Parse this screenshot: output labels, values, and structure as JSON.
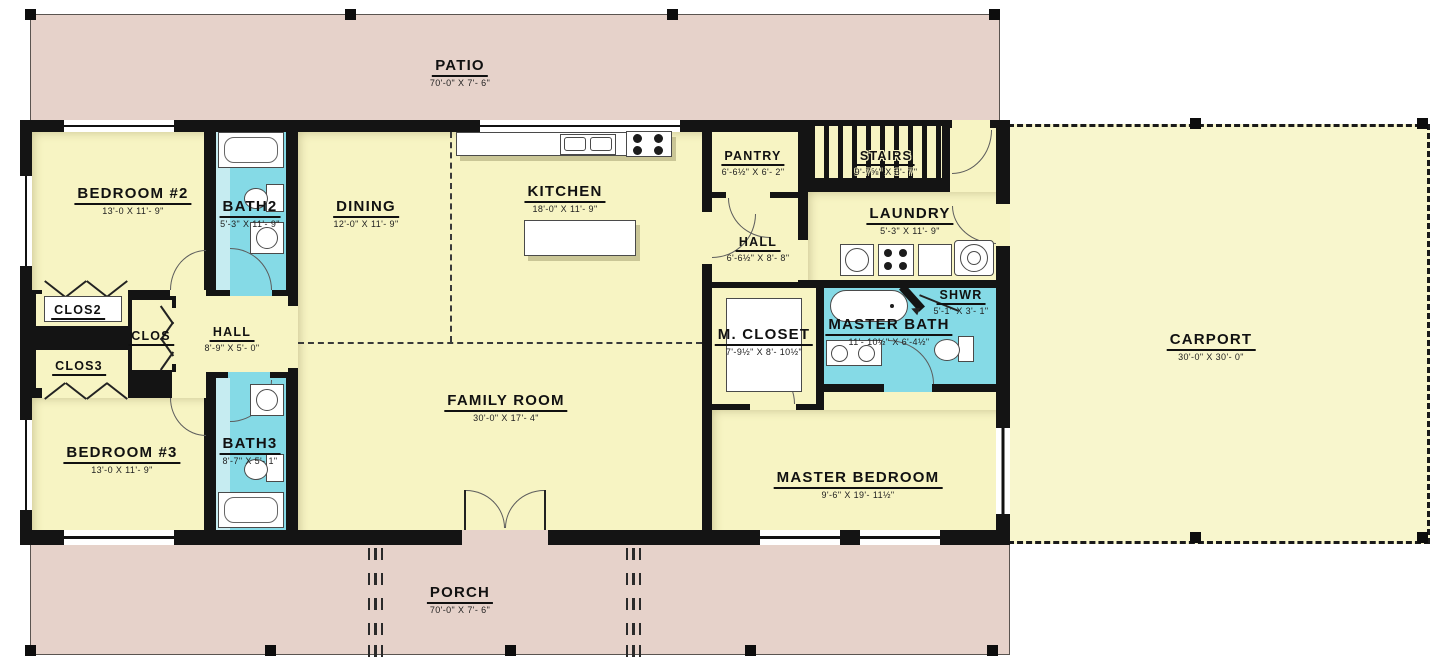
{
  "plan_type": "residential-floor-plan",
  "colors": {
    "deck_pink": "#e6d2ca",
    "room_yellow": "#f7f4c3",
    "carport_yellow": "#f8f6cd",
    "bath_cyan": "#85dae6",
    "bath_cyan_light": "#c6ecf1",
    "wall_black": "#141414"
  },
  "rooms": {
    "patio": {
      "label": "PATIO",
      "dims": "70'-0\" X 7'- 6\""
    },
    "bedroom2": {
      "label": "BEDROOM #2",
      "dims": "13'-0 X 11'- 9\""
    },
    "bath2": {
      "label": "BATH2",
      "dims": "5'-3\" X 11'- 9\""
    },
    "dining": {
      "label": "DINING",
      "dims": "12'-0\" X 11'- 9\""
    },
    "kitchen": {
      "label": "KITCHEN",
      "dims": "18'-0\" X 11'- 9\""
    },
    "pantry": {
      "label": "PANTRY",
      "dims": "6'-6½\" X 6'- 2\""
    },
    "stairs": {
      "label": "STAIRS",
      "dims": "9'-7⅝\" X 3'- 7\""
    },
    "hall_upper": {
      "label": "HALL",
      "dims": "6'-6½\" X 8'- 8\""
    },
    "laundry": {
      "label": "LAUNDRY",
      "dims": "5'-3\" X 11'- 9\""
    },
    "carport": {
      "label": "CARPORT",
      "dims": "30'-0\" X 30'- 0\""
    },
    "clos2": {
      "label": "CLOS2"
    },
    "clos": {
      "label": "CLOS"
    },
    "clos3": {
      "label": "CLOS3"
    },
    "hall_lower": {
      "label": "HALL",
      "dims": "8'-9\" X 5'- 0\""
    },
    "mcloset": {
      "label": "M. CLOSET",
      "dims": "7'-9½\" X 8'- 10½\""
    },
    "masterbath": {
      "label": "MASTER BATH",
      "dims": "11'- 10½\" X 6'-4½\""
    },
    "shwr": {
      "label": "SHWR",
      "dims": "5'-1\" X 3'- 1\""
    },
    "bedroom3": {
      "label": "BEDROOM #3",
      "dims": "13'-0 X 11'- 9\""
    },
    "bath3": {
      "label": "BATH3",
      "dims": "8'-7\" X 5'- 1\""
    },
    "family": {
      "label": "FAMILY ROOM",
      "dims": "30'-0\" X 17'- 4\""
    },
    "masterbed": {
      "label": "MASTER BEDROOM",
      "dims": "9'-6\" X 19'- 11½\""
    },
    "porch": {
      "label": "PORCH",
      "dims": "70'-0\" X 7'- 6\""
    }
  }
}
